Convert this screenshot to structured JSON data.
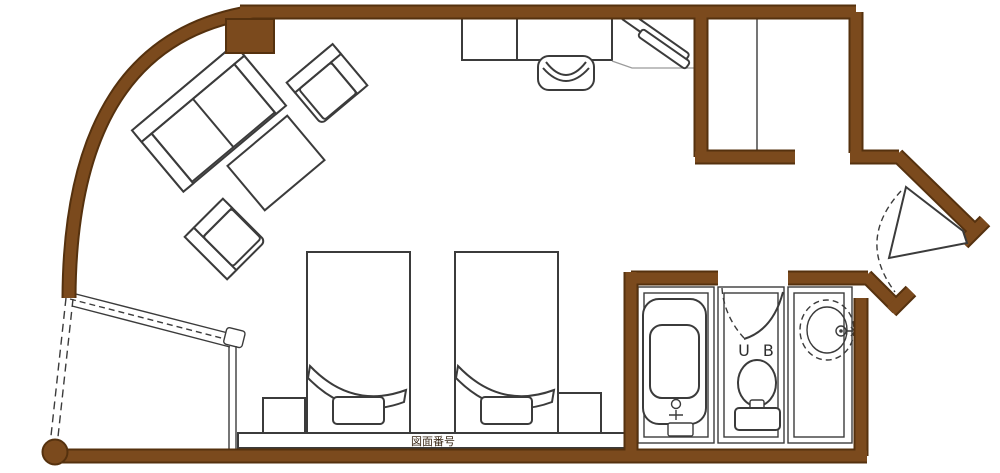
{
  "colors": {
    "wall": "#7b4a1d",
    "wall_outline": "#55310e",
    "line": "#3b3b3b",
    "line_light": "#9b9b9b",
    "background": "#ffffff",
    "label_text": "#2f2f2f",
    "stamp_text": "#3a2817"
  },
  "labels": {
    "unit_bath": "U B",
    "headboard_stamp": "図面番号"
  }
}
